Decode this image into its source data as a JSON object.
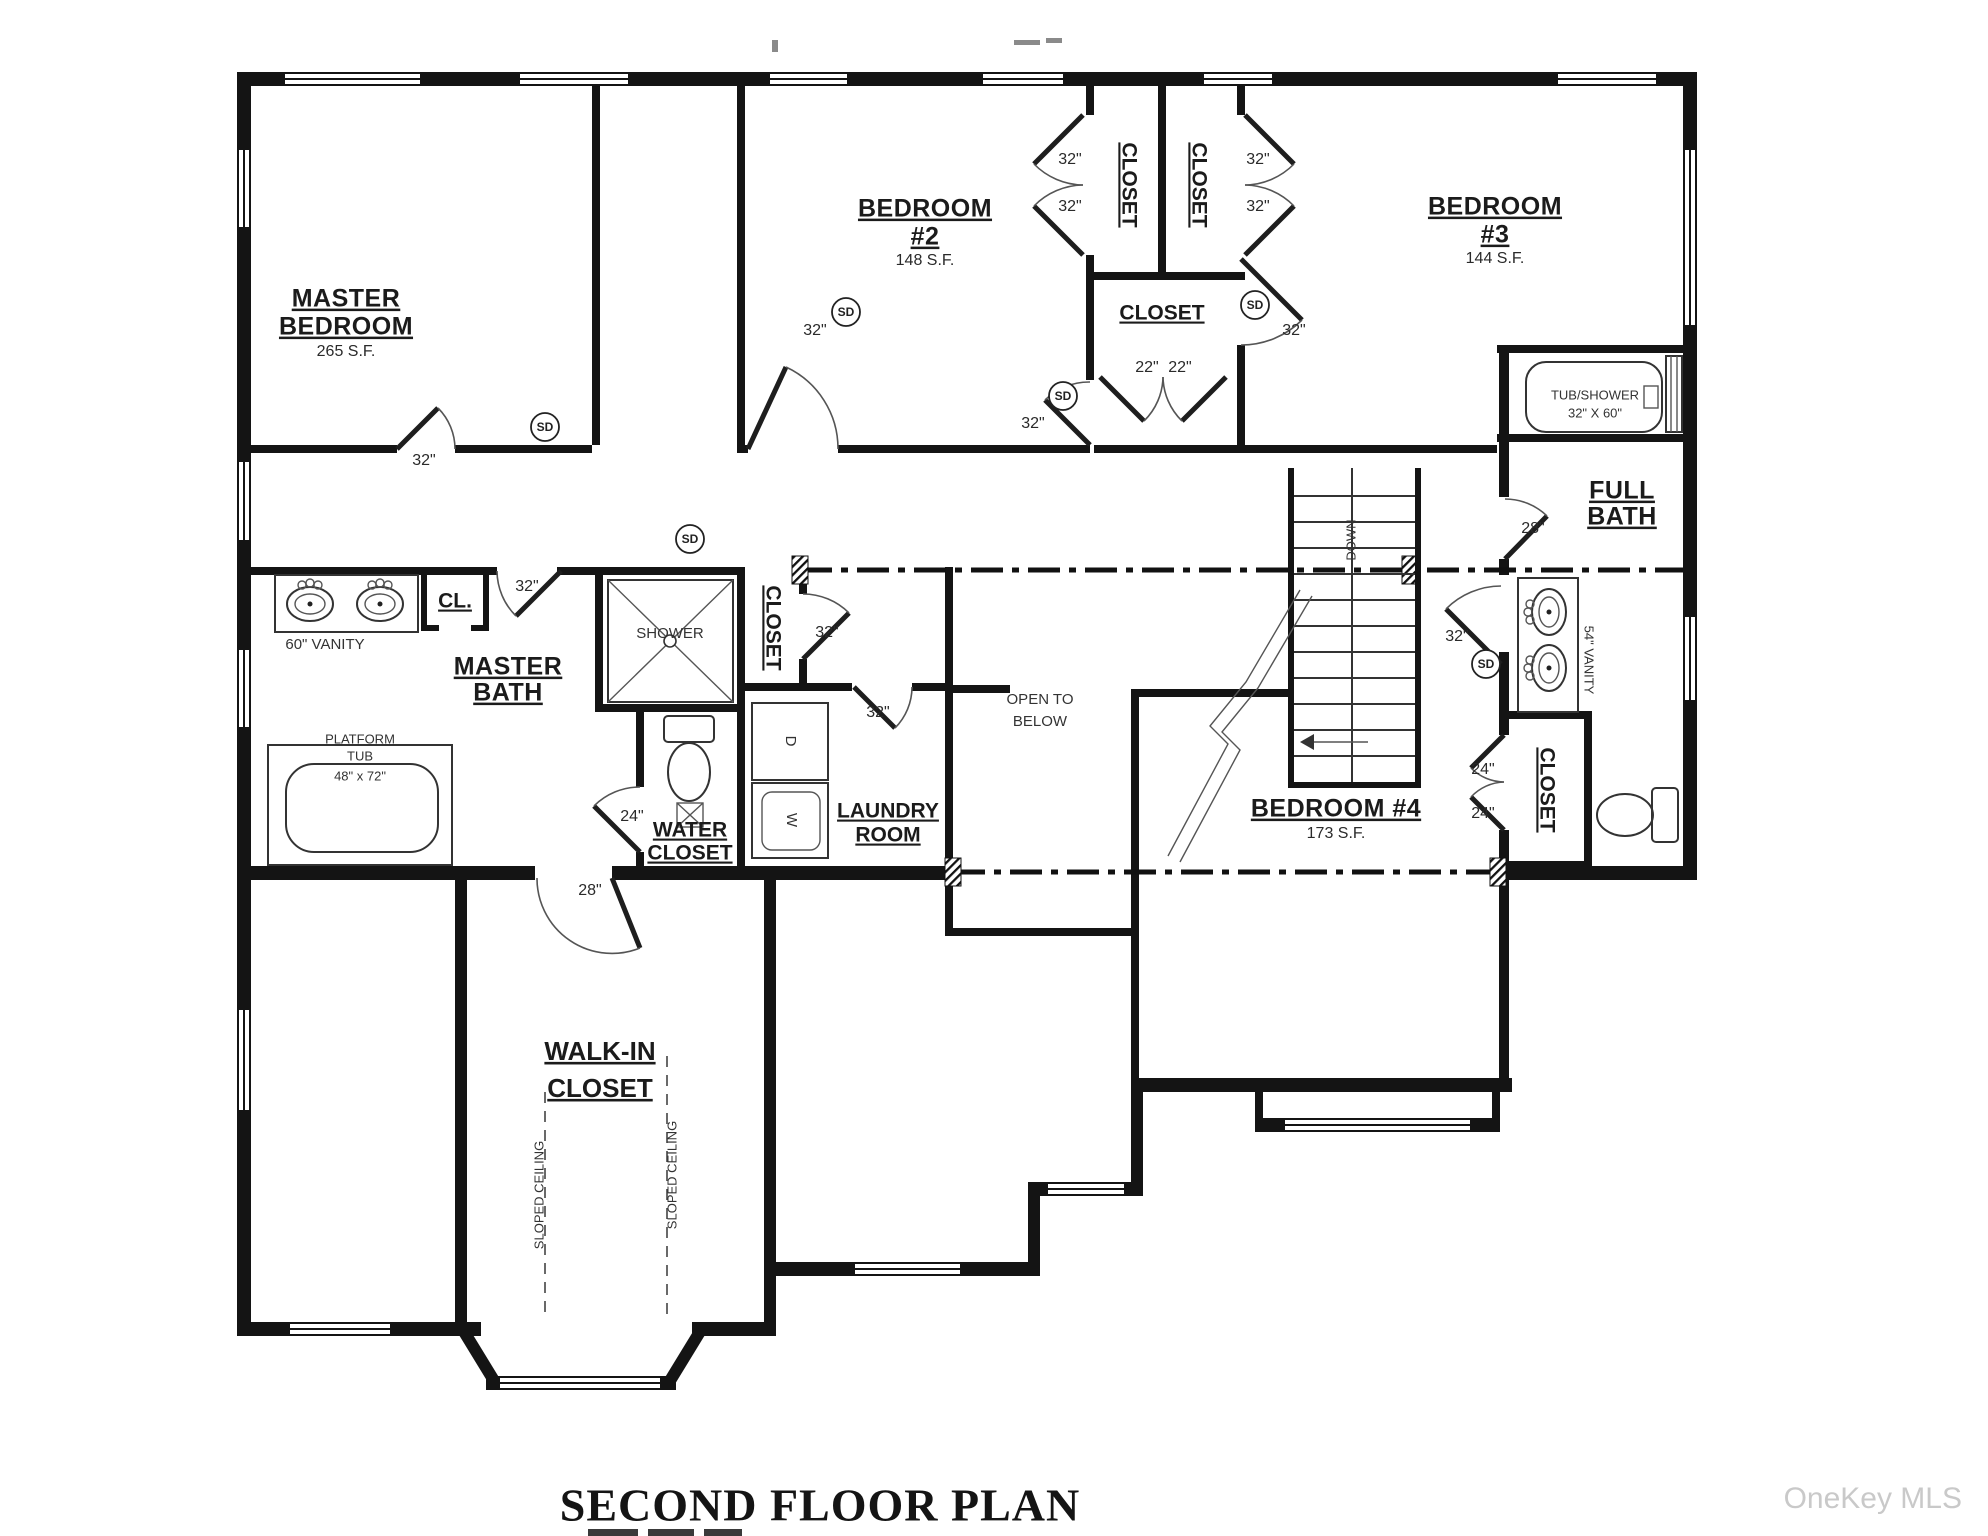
{
  "page": {
    "title": "SECOND FLOOR PLAN",
    "watermark": "OneKey MLS"
  },
  "rooms": {
    "master_bedroom": {
      "l1": "MASTER",
      "l2": "BEDROOM",
      "area": "265 S.F."
    },
    "bedroom2": {
      "l1": "BEDROOM",
      "l2": "#2",
      "area": "148 S.F."
    },
    "bedroom3": {
      "l1": "BEDROOM",
      "l2": "#3",
      "area": "144 S.F."
    },
    "bedroom4": {
      "l1": "BEDROOM #4",
      "area": "173 S.F."
    },
    "master_bath": {
      "l1": "MASTER",
      "l2": "BATH"
    },
    "full_bath": {
      "l1": "FULL",
      "l2": "BATH"
    },
    "water_closet": {
      "l1": "WATER",
      "l2": "CLOSET"
    },
    "laundry_room": {
      "l1": "LAUNDRY",
      "l2": "ROOM"
    },
    "walk_in_closet": {
      "l1": "WALK-IN",
      "l2": "CLOSET"
    },
    "open_to_below": {
      "l1": "OPEN TO",
      "l2": "BELOW"
    },
    "closet": "CLOSET",
    "cl": "CL."
  },
  "fixtures": {
    "shower": "SHOWER",
    "tub_shower_l1": "TUB/SHOWER",
    "tub_shower_l2": "32\" X 60\"",
    "platform_tub_l1": "PLATFORM",
    "platform_tub_l2": "TUB",
    "platform_tub_size": "48\" x 72\"",
    "vanity_60": "60\" VANITY",
    "vanity_54": "54\" VANITY",
    "dryer": "D",
    "washer": "W",
    "down": "DOWN",
    "sloped_ceiling": "SLOPED CEILING",
    "smoke_detector": "SD"
  },
  "dims": {
    "d22": "22\"",
    "d24": "24\"",
    "d28": "28\"",
    "d32": "32\""
  }
}
